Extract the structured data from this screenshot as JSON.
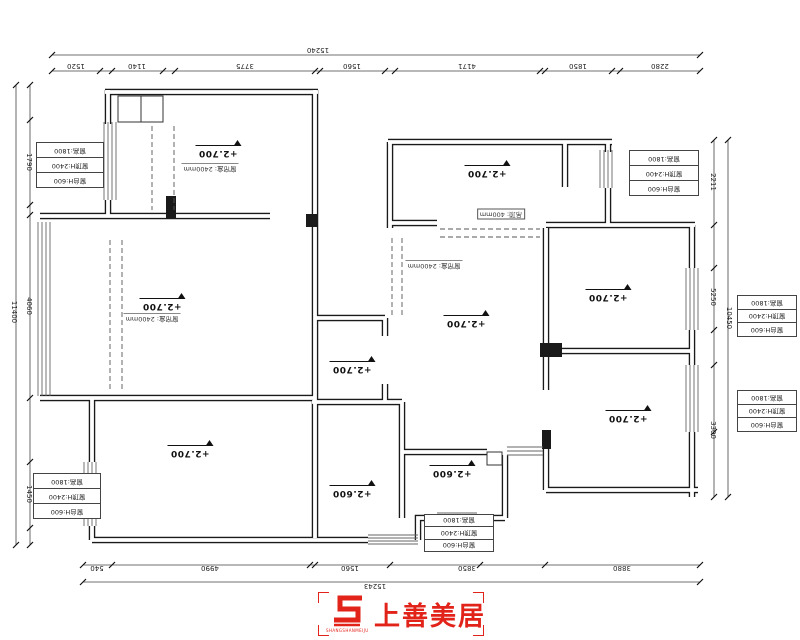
{
  "drawing": {
    "type": "residential floor plan (ceiling/elevation plan)"
  },
  "elevation_labels": [
    {
      "id": "bedroom-top-left",
      "text": "+2.700",
      "x": 218,
      "y": 152
    },
    {
      "id": "living-left",
      "text": "+2.700",
      "x": 162,
      "y": 305
    },
    {
      "id": "bedroom-bottom-left",
      "text": "+2.700",
      "x": 190,
      "y": 452
    },
    {
      "id": "bath-center",
      "text": "+2.700",
      "x": 352,
      "y": 368
    },
    {
      "id": "kitchen-center-bottom",
      "text": "+2.600",
      "x": 352,
      "y": 492
    },
    {
      "id": "dining-center",
      "text": "+2.700",
      "x": 466,
      "y": 322
    },
    {
      "id": "room-top-right",
      "text": "+2.700",
      "x": 487,
      "y": 172
    },
    {
      "id": "bedroom-right-top",
      "text": "+2.700",
      "x": 608,
      "y": 296
    },
    {
      "id": "bedroom-right-bottom",
      "text": "+2.700",
      "x": 628,
      "y": 417
    },
    {
      "id": "bath-right-bottom",
      "text": "+2.600",
      "x": 452,
      "y": 472
    }
  ],
  "ceiling_notes": [
    {
      "text": "窗帘盒: 2400mm",
      "x": 210,
      "y": 168,
      "boxed": false
    },
    {
      "text": "窗帘盒: 2400mm",
      "x": 152,
      "y": 318,
      "boxed": false
    },
    {
      "text": "窗帘盒: 2400mm",
      "x": 434,
      "y": 265,
      "boxed": false
    },
    {
      "text": "吊顶: 400mm",
      "x": 501,
      "y": 214,
      "boxed": true
    }
  ],
  "window_boxes": {
    "rows": [
      "窗台H:600",
      "窗顶H:2400",
      "窗高:1800"
    ],
    "positions": [
      {
        "x": 36,
        "y": 142,
        "w": 66,
        "h": 44
      },
      {
        "x": 33,
        "y": 473,
        "w": 66,
        "h": 44
      },
      {
        "x": 629,
        "y": 150,
        "w": 68,
        "h": 44
      },
      {
        "x": 737,
        "y": 295,
        "w": 58,
        "h": 40
      },
      {
        "x": 737,
        "y": 390,
        "w": 58,
        "h": 40
      },
      {
        "x": 424,
        "y": 514,
        "w": 68,
        "h": 36
      }
    ]
  },
  "dimensions": {
    "texts": [
      {
        "text": "15240",
        "x": 318,
        "y": 50,
        "rot": 180
      },
      {
        "text": "1520",
        "x": 76,
        "y": 66,
        "rot": 180
      },
      {
        "text": "1140",
        "x": 137,
        "y": 66,
        "rot": 180
      },
      {
        "text": "3775",
        "x": 245,
        "y": 66,
        "rot": 180
      },
      {
        "text": "1560",
        "x": 352,
        "y": 66,
        "rot": 180
      },
      {
        "text": "4171",
        "x": 467,
        "y": 66,
        "rot": 180
      },
      {
        "text": "1850",
        "x": 578,
        "y": 66,
        "rot": 180
      },
      {
        "text": "2280",
        "x": 660,
        "y": 66,
        "rot": 180
      },
      {
        "text": "540",
        "x": 97,
        "y": 568,
        "rot": 180
      },
      {
        "text": "4990",
        "x": 210,
        "y": 568,
        "rot": 180
      },
      {
        "text": "1560",
        "x": 350,
        "y": 568,
        "rot": 180
      },
      {
        "text": "3850",
        "x": 467,
        "y": 568,
        "rot": 180
      },
      {
        "text": "3880",
        "x": 622,
        "y": 568,
        "rot": 180
      },
      {
        "text": "15243",
        "x": 375,
        "y": 586,
        "rot": 180
      },
      {
        "text": "11400",
        "x": 14,
        "y": 312,
        "rot": 90
      },
      {
        "text": "1790",
        "x": 29,
        "y": 162,
        "rot": 90
      },
      {
        "text": "4060",
        "x": 29,
        "y": 306,
        "rot": 90
      },
      {
        "text": "1450",
        "x": 29,
        "y": 494,
        "rot": 90
      },
      {
        "text": "10450",
        "x": 729,
        "y": 318,
        "rot": 90
      },
      {
        "text": "2211",
        "x": 713,
        "y": 182,
        "rot": 90
      },
      {
        "text": "5250",
        "x": 713,
        "y": 297,
        "rot": 90
      },
      {
        "text": "3300",
        "x": 713,
        "y": 430,
        "rot": 90
      }
    ]
  },
  "logo": {
    "brand": "上善美居",
    "caption": "SHANGSHANMEIJU",
    "color": "#e2231a"
  }
}
